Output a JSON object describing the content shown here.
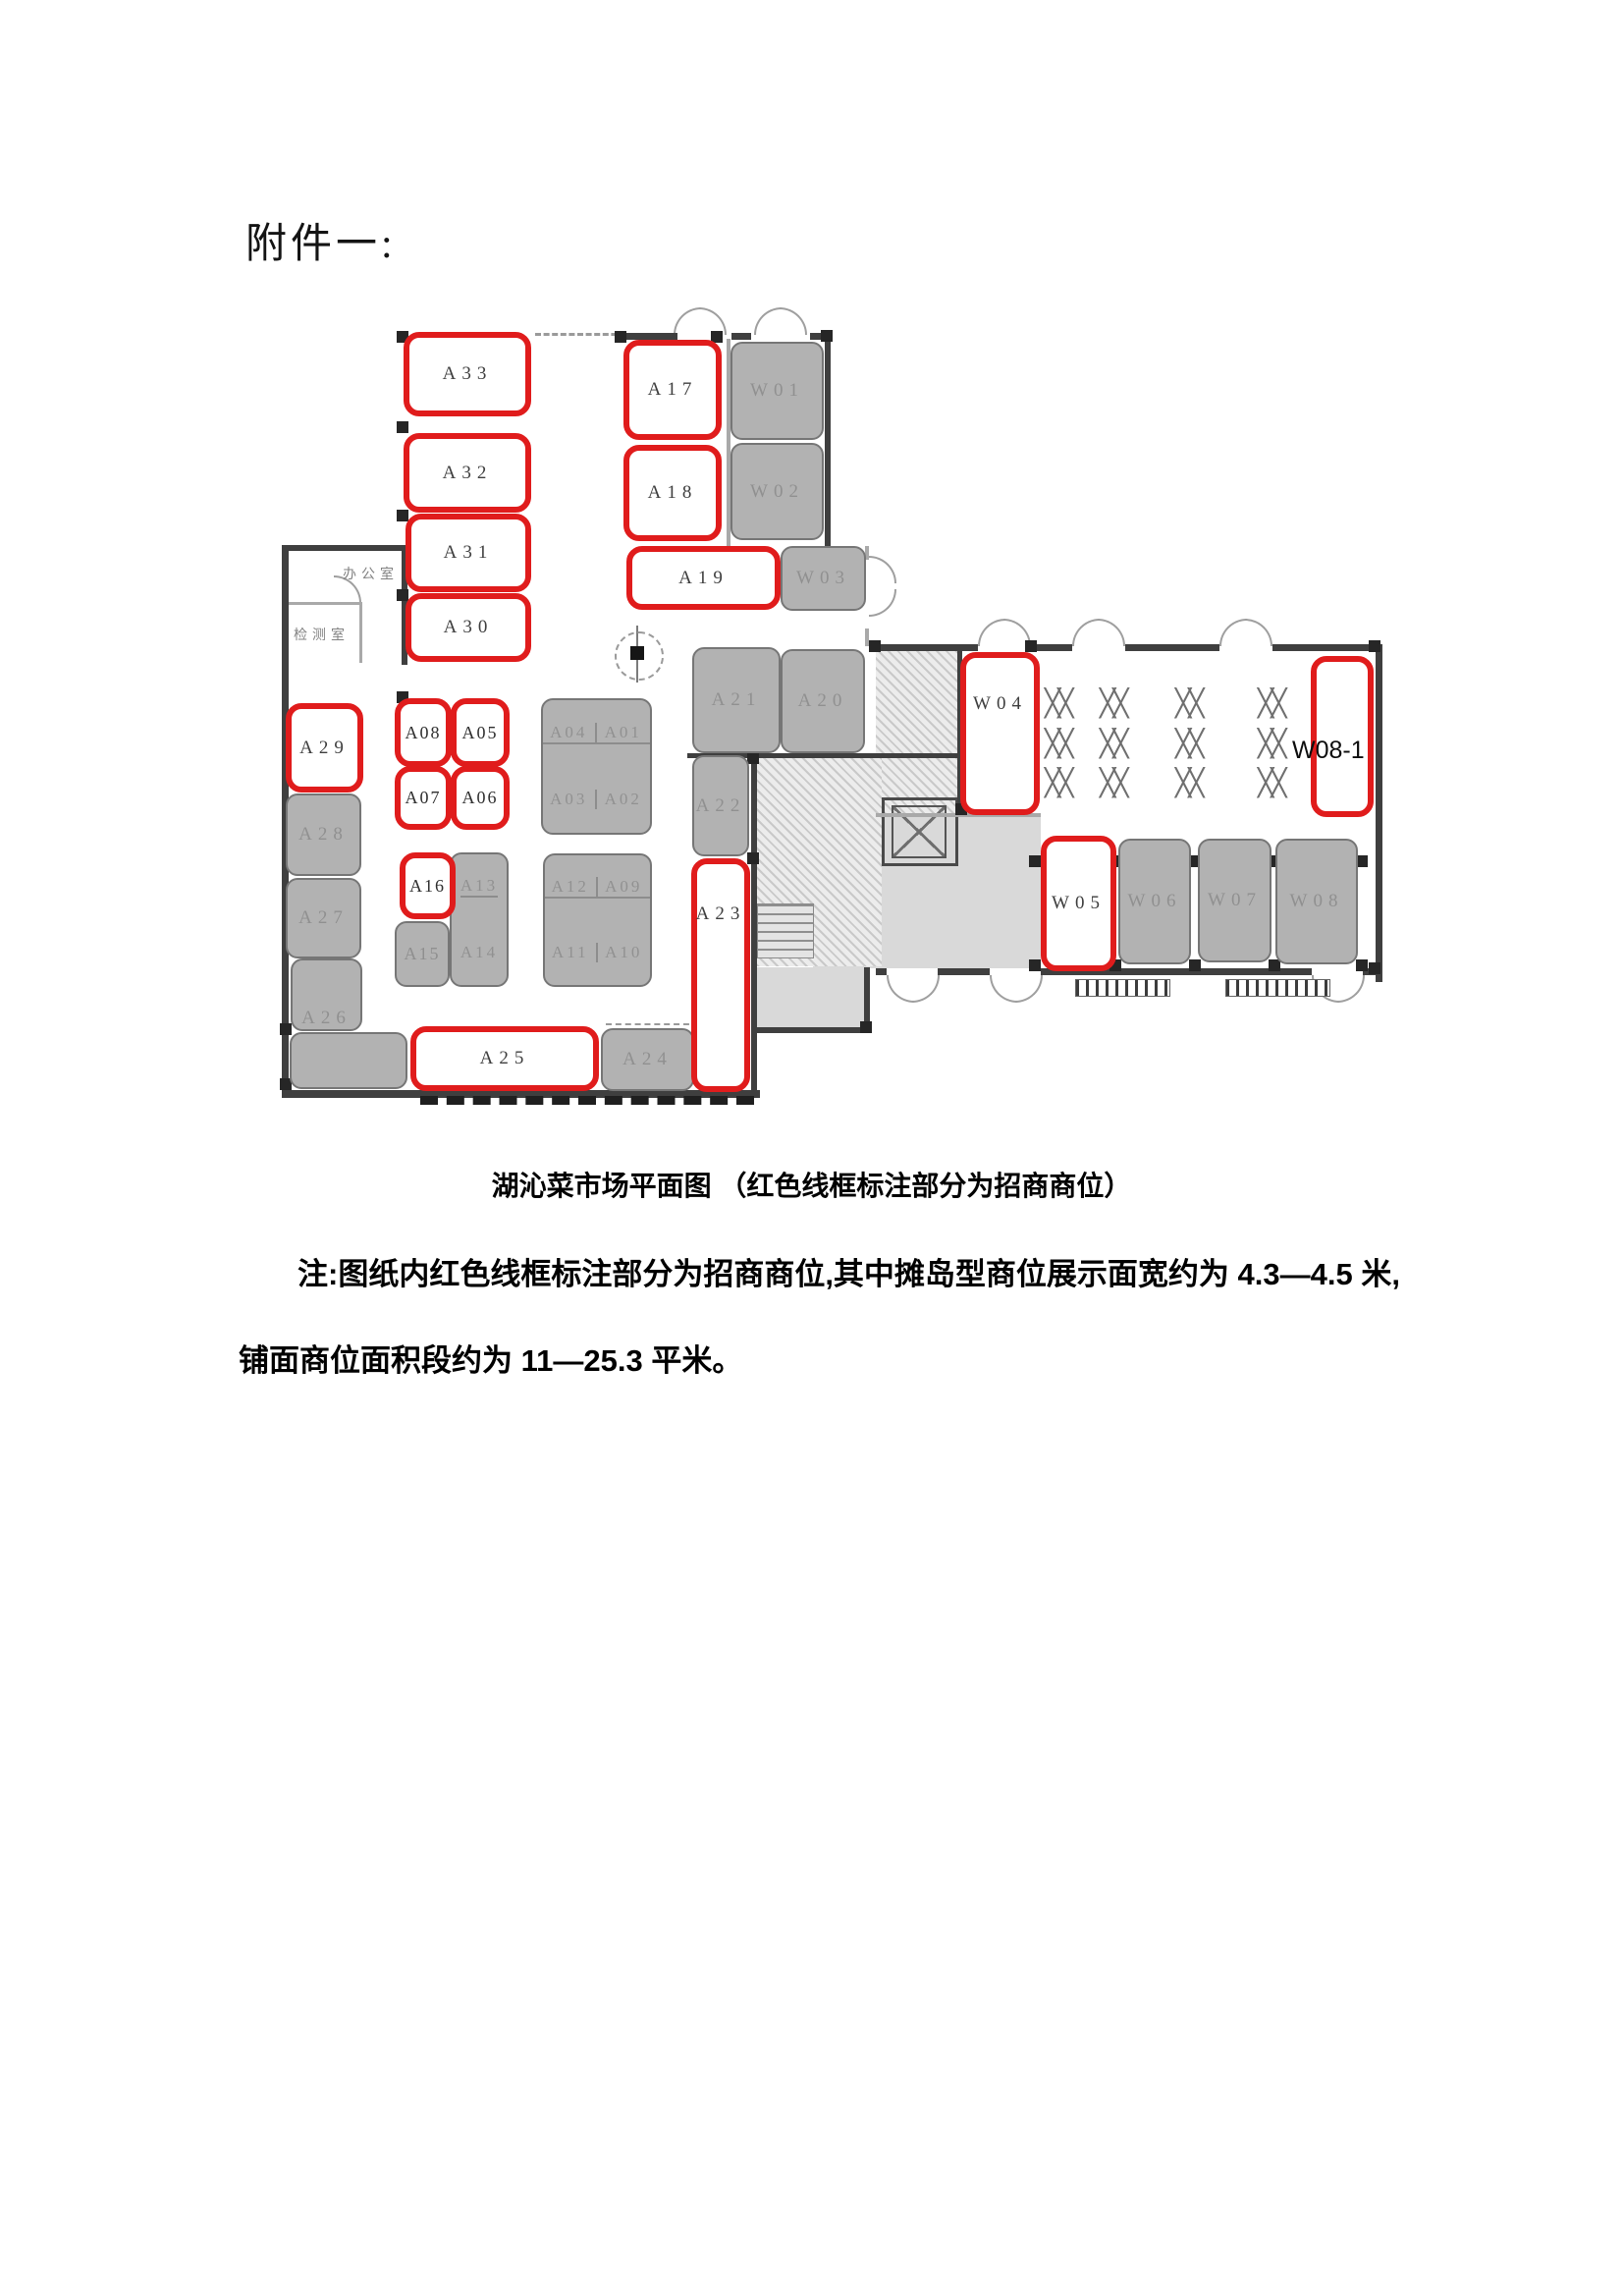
{
  "page": {
    "heading": "附件一:"
  },
  "figure": {
    "caption": "湖沁菜市场平面图 （红色线框标注部分为招商商位）",
    "note_line1": "注:图纸内红色线框标注部分为招商商位,其中摊岛型商位展示面宽约为 4.3—4.5 米,",
    "note_line2": "铺面商位面积段约为 11—25.3 平米。"
  },
  "plan": {
    "colors": {
      "available_outline": "#e01c1c",
      "occupied_fill": "#b2b2b2",
      "wall": "#3f3f3f"
    },
    "rooms": {
      "office": "办公室",
      "inspection": "检测室"
    },
    "dining_table_glyph": "╳╳",
    "available": {
      "a33": "A33",
      "a32": "A32",
      "a31": "A31",
      "a30": "A30",
      "a17": "A17",
      "a18": "A18",
      "a19": "A19",
      "a29": "A29",
      "a08": "A08",
      "a05": "A05",
      "a07": "A07",
      "a06": "A06",
      "a16": "A16",
      "a25": "A25",
      "a23": "A23",
      "w04": "W04",
      "w05": "W05",
      "w08_1": "W08-1"
    },
    "occupied": {
      "w01": "W01",
      "w02": "W02",
      "w03": "W03",
      "a28": "A28",
      "a27": "A27",
      "a26": "A26",
      "a21": "A21",
      "a20": "A20",
      "a22": "A22",
      "a24": "A24",
      "a15": "A15",
      "a13": "A13",
      "a14": "A14",
      "a04": "A04",
      "a01": "A01",
      "a03": "A03",
      "a02": "A02",
      "a12": "A12",
      "a09": "A09",
      "a11": "A11",
      "a10": "A10",
      "w06": "W06",
      "w07": "W07",
      "w08": "W08"
    }
  }
}
